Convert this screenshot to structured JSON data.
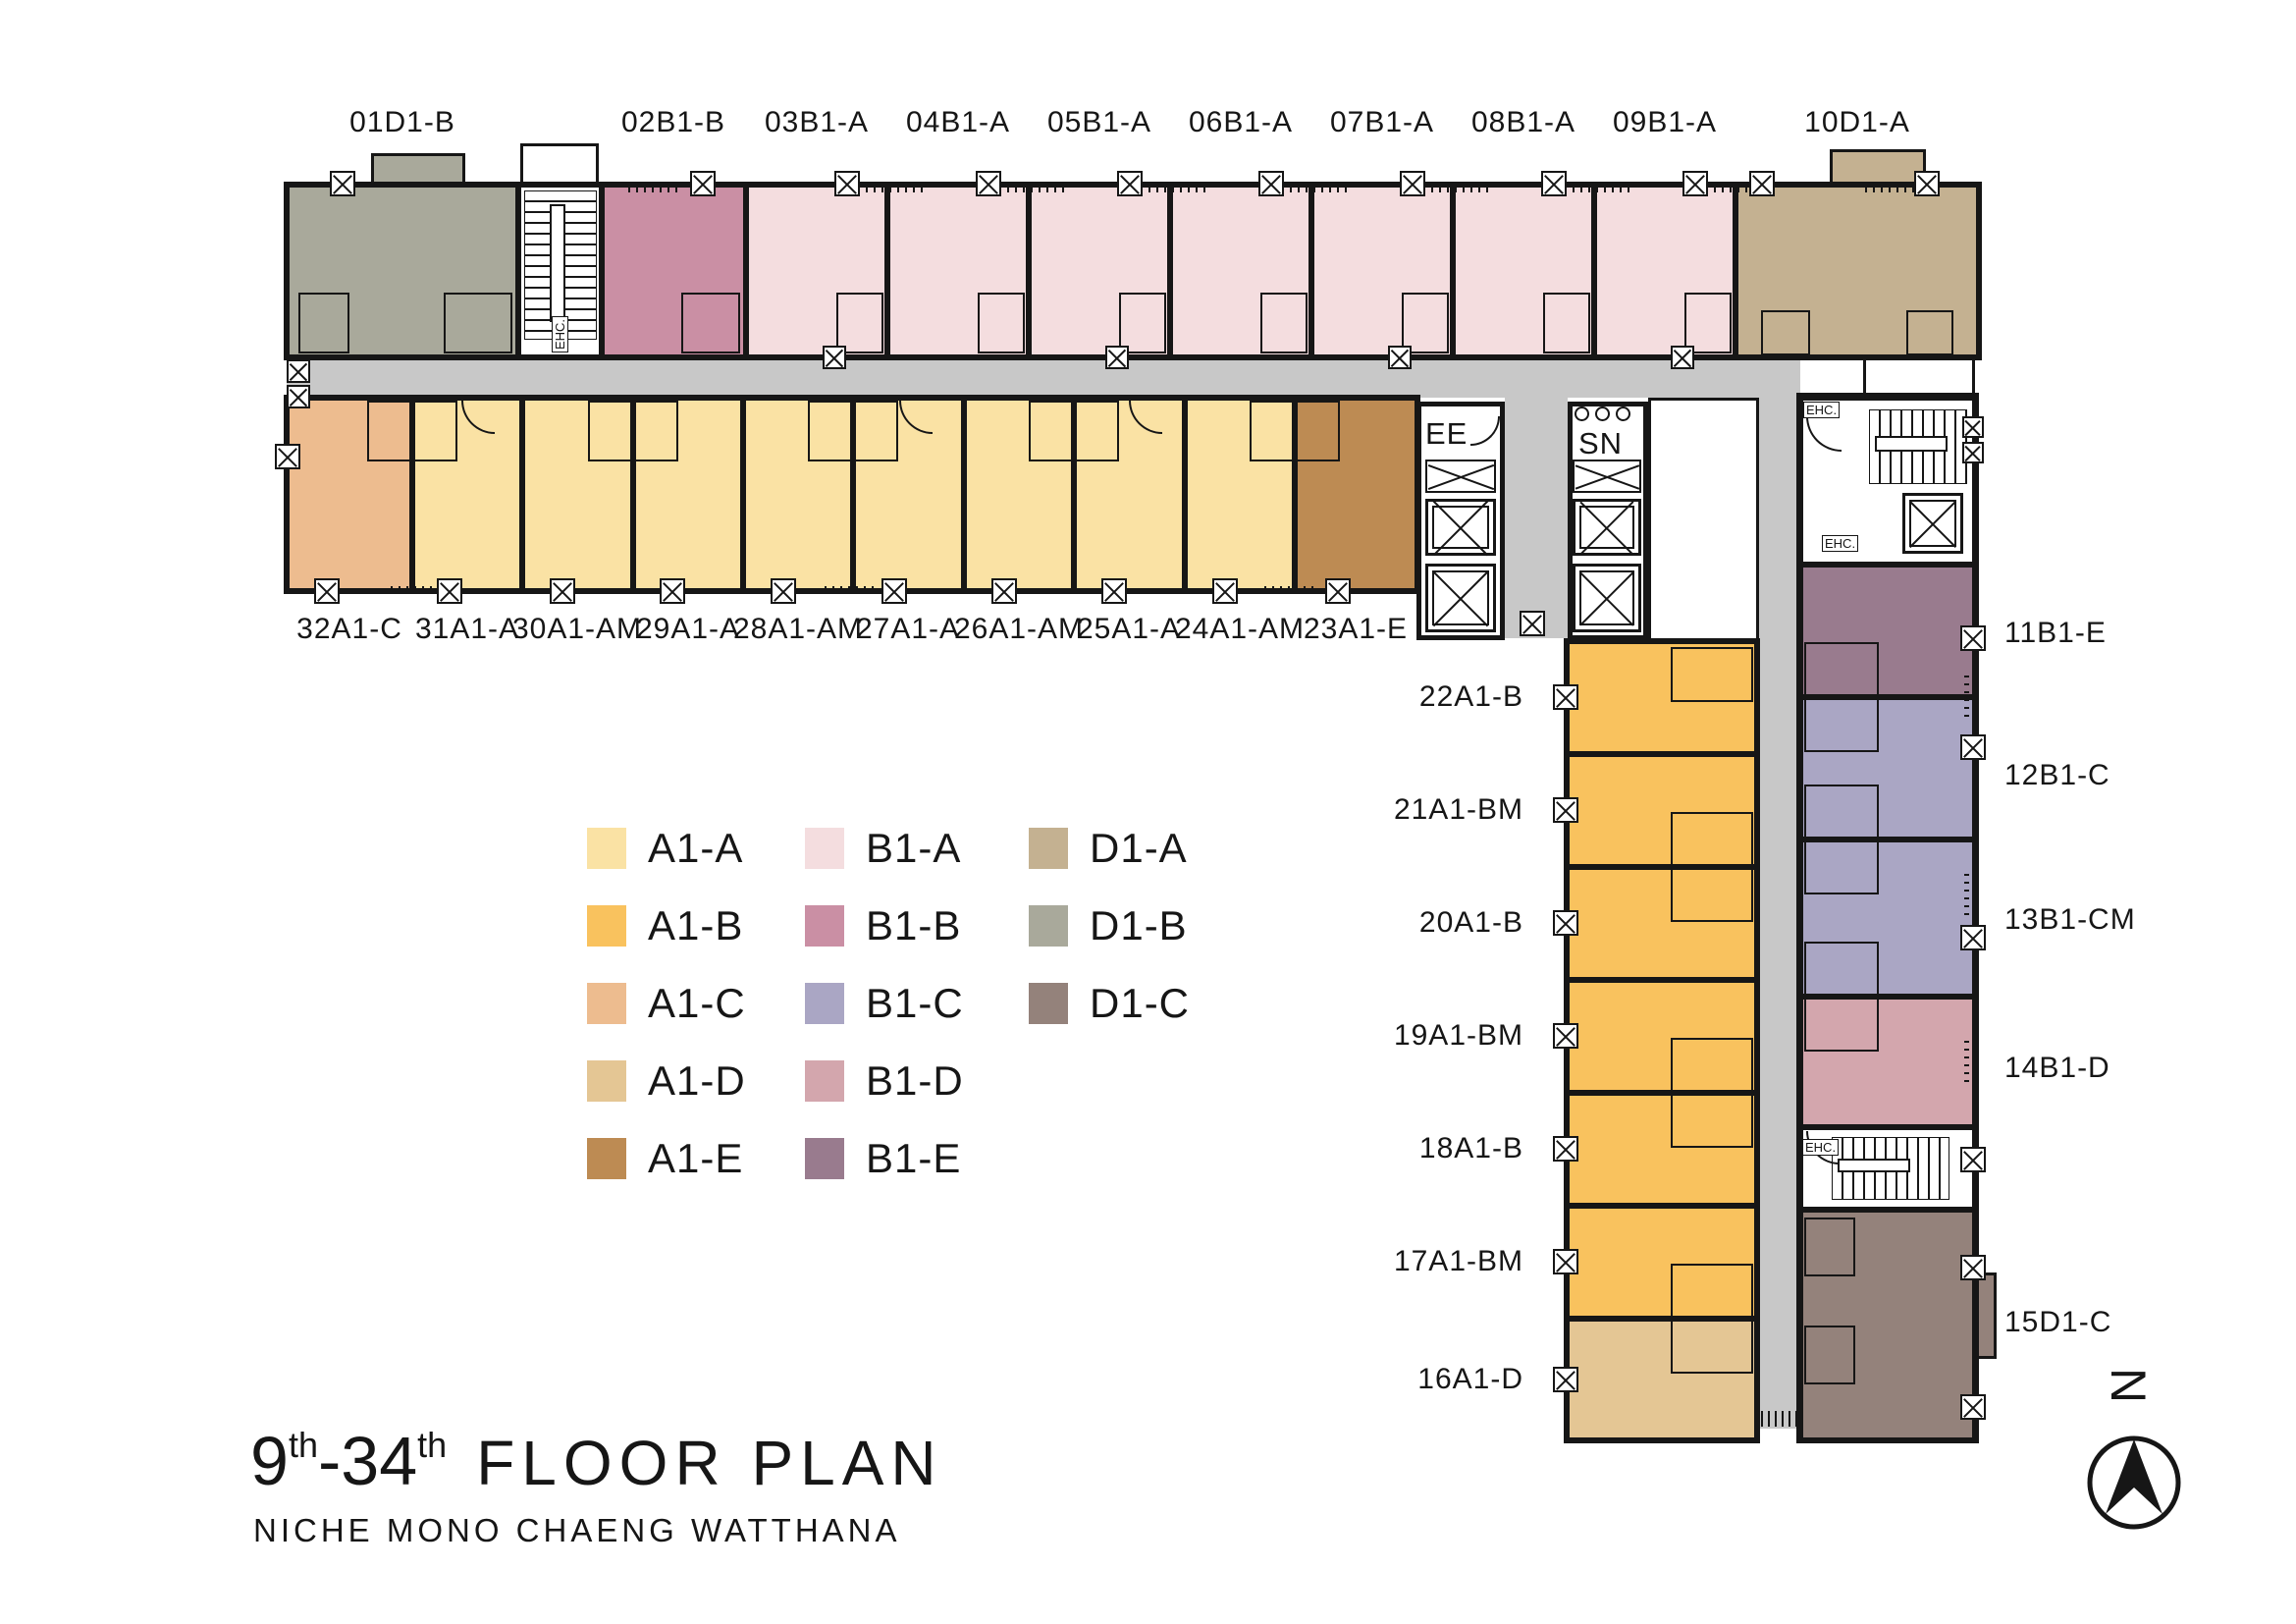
{
  "title": {
    "start_num": "9",
    "start_sup": "th",
    "dash": "-",
    "end_num": "34",
    "end_sup": "th",
    "main": "FLOOR PLAN",
    "subtitle": "NICHE MONO CHAENG WATTHANA"
  },
  "north": {
    "label": "N"
  },
  "core": {
    "ee": "EE",
    "sn": "SN",
    "ehc": "EHC."
  },
  "colors": {
    "A1-A": "#fae2a4",
    "A1-B": "#f9c25e",
    "A1-C": "#edbc8f",
    "A1-D": "#e4c694",
    "A1-E": "#bd8b53",
    "B1-A": "#f4dddf",
    "B1-B": "#ca8fa4",
    "B1-C": "#aaa6c4",
    "B1-D": "#d3a6ad",
    "B1-E": "#997b8e",
    "D1-A": "#c4b191",
    "D1-B": "#a9a99b",
    "D1-C": "#94827b",
    "corridor": "#c8c8c8",
    "wall": "#161616"
  },
  "legend": {
    "columns": [
      [
        "A1-A",
        "A1-B",
        "A1-C",
        "A1-D",
        "A1-E"
      ],
      [
        "B1-A",
        "B1-B",
        "B1-C",
        "B1-D",
        "B1-E"
      ],
      [
        "D1-A",
        "D1-B",
        "D1-C"
      ]
    ]
  },
  "plan": {
    "corridor": {
      "type": "corridor"
    },
    "top_wing": [
      {
        "label": "01D1-B",
        "type": "D1-B"
      },
      {
        "label": "02B1-B",
        "type": "B1-B"
      },
      {
        "label": "03B1-A",
        "type": "B1-A"
      },
      {
        "label": "04B1-A",
        "type": "B1-A"
      },
      {
        "label": "05B1-A",
        "type": "B1-A"
      },
      {
        "label": "06B1-A",
        "type": "B1-A"
      },
      {
        "label": "07B1-A",
        "type": "B1-A"
      },
      {
        "label": "08B1-A",
        "type": "B1-A"
      },
      {
        "label": "09B1-A",
        "type": "B1-A"
      },
      {
        "label": "10D1-A",
        "type": "D1-A"
      }
    ],
    "second_wing": [
      {
        "label": "32A1-C",
        "type": "A1-C"
      },
      {
        "label": "31A1-A",
        "type": "A1-A"
      },
      {
        "label": "30A1-AM",
        "type": "A1-A"
      },
      {
        "label": "29A1-A",
        "type": "A1-A"
      },
      {
        "label": "28A1-AM",
        "type": "A1-A"
      },
      {
        "label": "27A1-A",
        "type": "A1-A"
      },
      {
        "label": "26A1-AM",
        "type": "A1-A"
      },
      {
        "label": "25A1-A",
        "type": "A1-A"
      },
      {
        "label": "24A1-AM",
        "type": "A1-A"
      },
      {
        "label": "23A1-E",
        "type": "A1-E"
      }
    ],
    "tower_left": [
      {
        "label": "22A1-B",
        "type": "A1-B"
      },
      {
        "label": "21A1-BM",
        "type": "A1-B"
      },
      {
        "label": "20A1-B",
        "type": "A1-B"
      },
      {
        "label": "19A1-BM",
        "type": "A1-B"
      },
      {
        "label": "18A1-B",
        "type": "A1-B"
      },
      {
        "label": "17A1-BM",
        "type": "A1-B"
      },
      {
        "label": "16A1-D",
        "type": "A1-D"
      }
    ],
    "tower_right": [
      {
        "label": "11B1-E",
        "type": "B1-E"
      },
      {
        "label": "12B1-C",
        "type": "B1-C"
      },
      {
        "label": "13B1-CM",
        "type": "B1-C"
      },
      {
        "label": "14B1-D",
        "type": "B1-D"
      },
      {
        "label": "15D1-C",
        "type": "D1-C"
      }
    ]
  }
}
